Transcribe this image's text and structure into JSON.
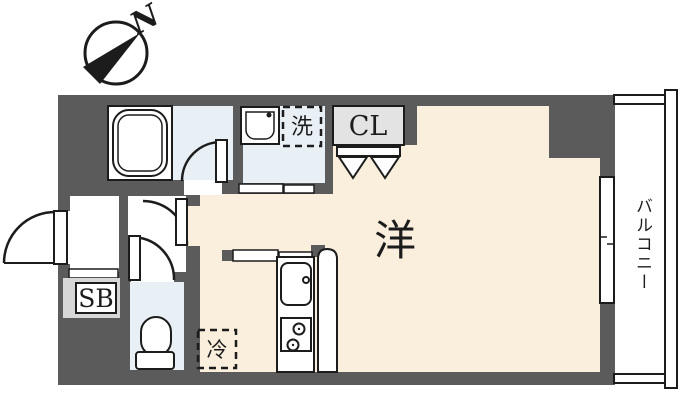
{
  "title": "apartment-floor-plan",
  "compass": {
    "north_label": "N"
  },
  "labels": {
    "living_room": "洋",
    "closet": "CL",
    "shoe_box": "SB",
    "washer_space": "洗",
    "refrigerator_space": "冷",
    "balcony": "バルコニー"
  },
  "colors": {
    "wall": "#5b5b5b",
    "floor_main": "#f9efdc",
    "floor_wet": "#e8f0f6",
    "floor_entrance": "#d7d7d7",
    "line": "#1c1c1c",
    "background": "#ffffff"
  },
  "fixtures": [
    "compass-north",
    "bathtub",
    "washbasin",
    "washing-machine-space",
    "closet-folding-doors",
    "entrance-door",
    "bathroom-door",
    "room-door",
    "toilet-door",
    "toilet",
    "kitchen-sink",
    "stove-two-burners",
    "refrigerator-space",
    "sliding-window-balcony",
    "balcony-railing",
    "shoe-box"
  ]
}
